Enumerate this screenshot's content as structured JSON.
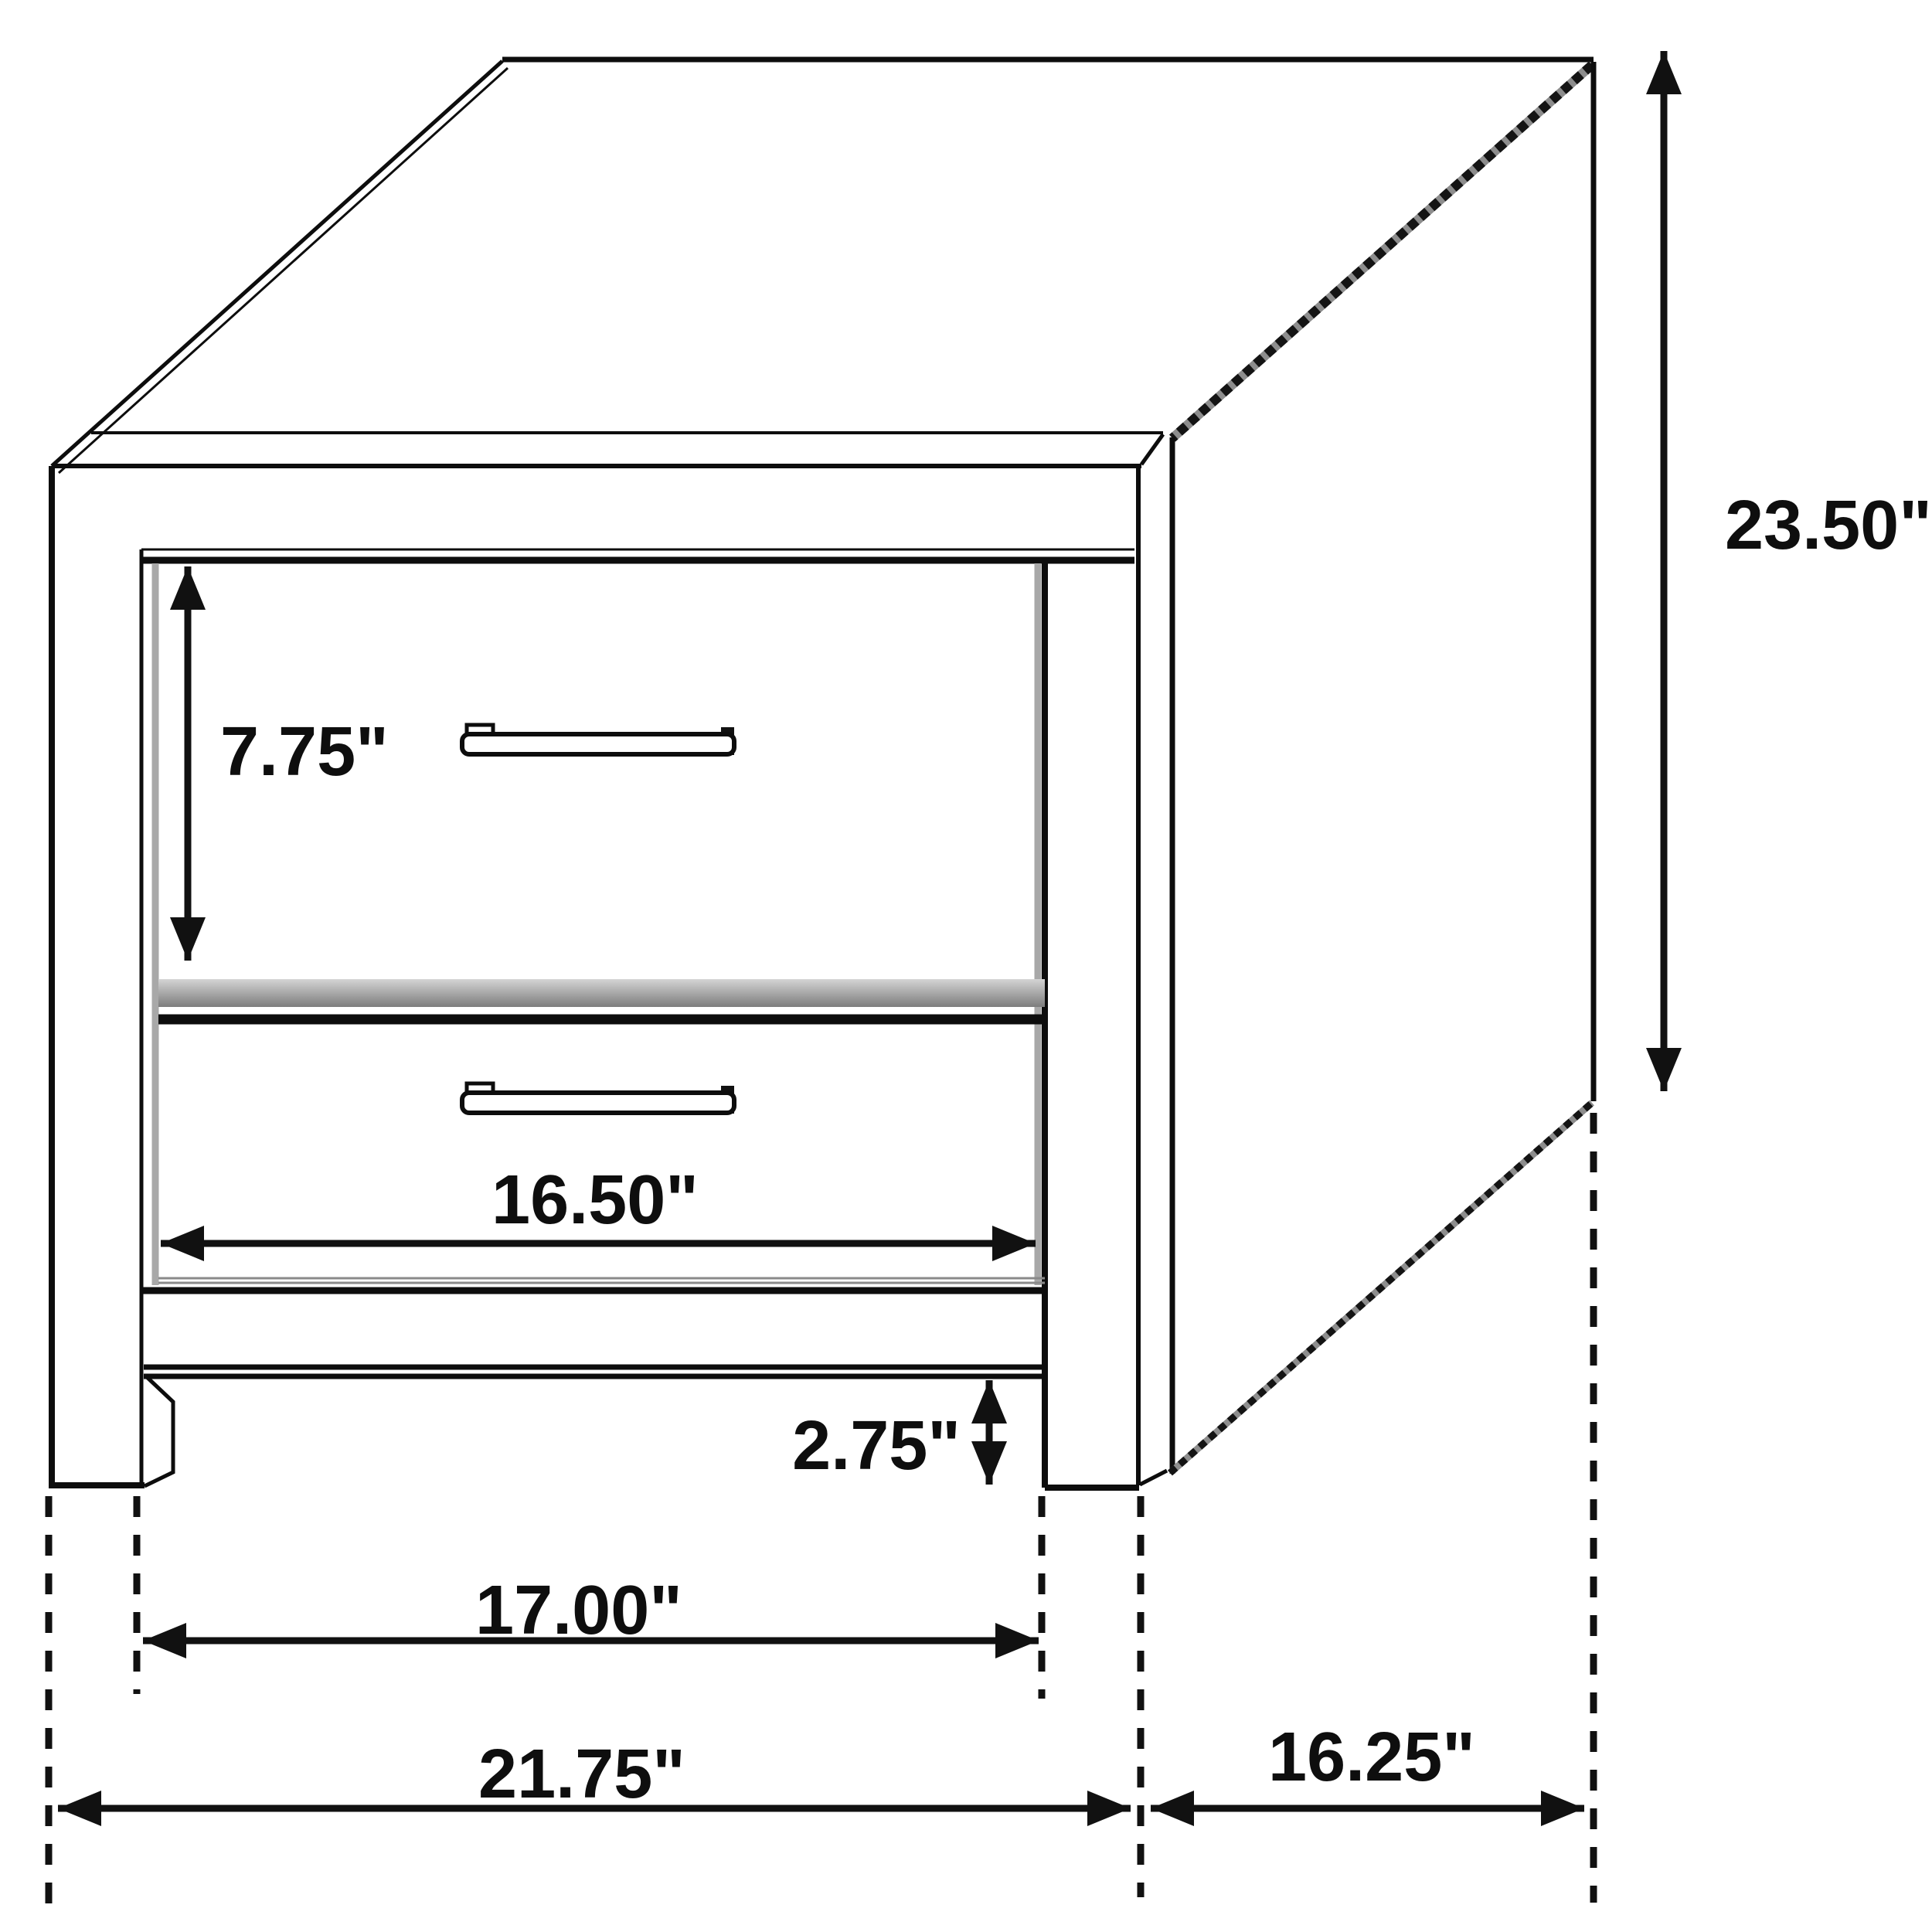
{
  "diagram": {
    "background_color": "#ffffff",
    "line_color": "#0d0d0d",
    "shadow_color": "#a8a8a8",
    "labels": {
      "drawer_front_height": "7.75\"",
      "overall_height": "23.50\"",
      "drawer_width": "16.50\"",
      "leg_height": "2.75\"",
      "between_legs_width": "17.00\"",
      "overall_width": "21.75\"",
      "overall_depth": "16.25\""
    }
  }
}
